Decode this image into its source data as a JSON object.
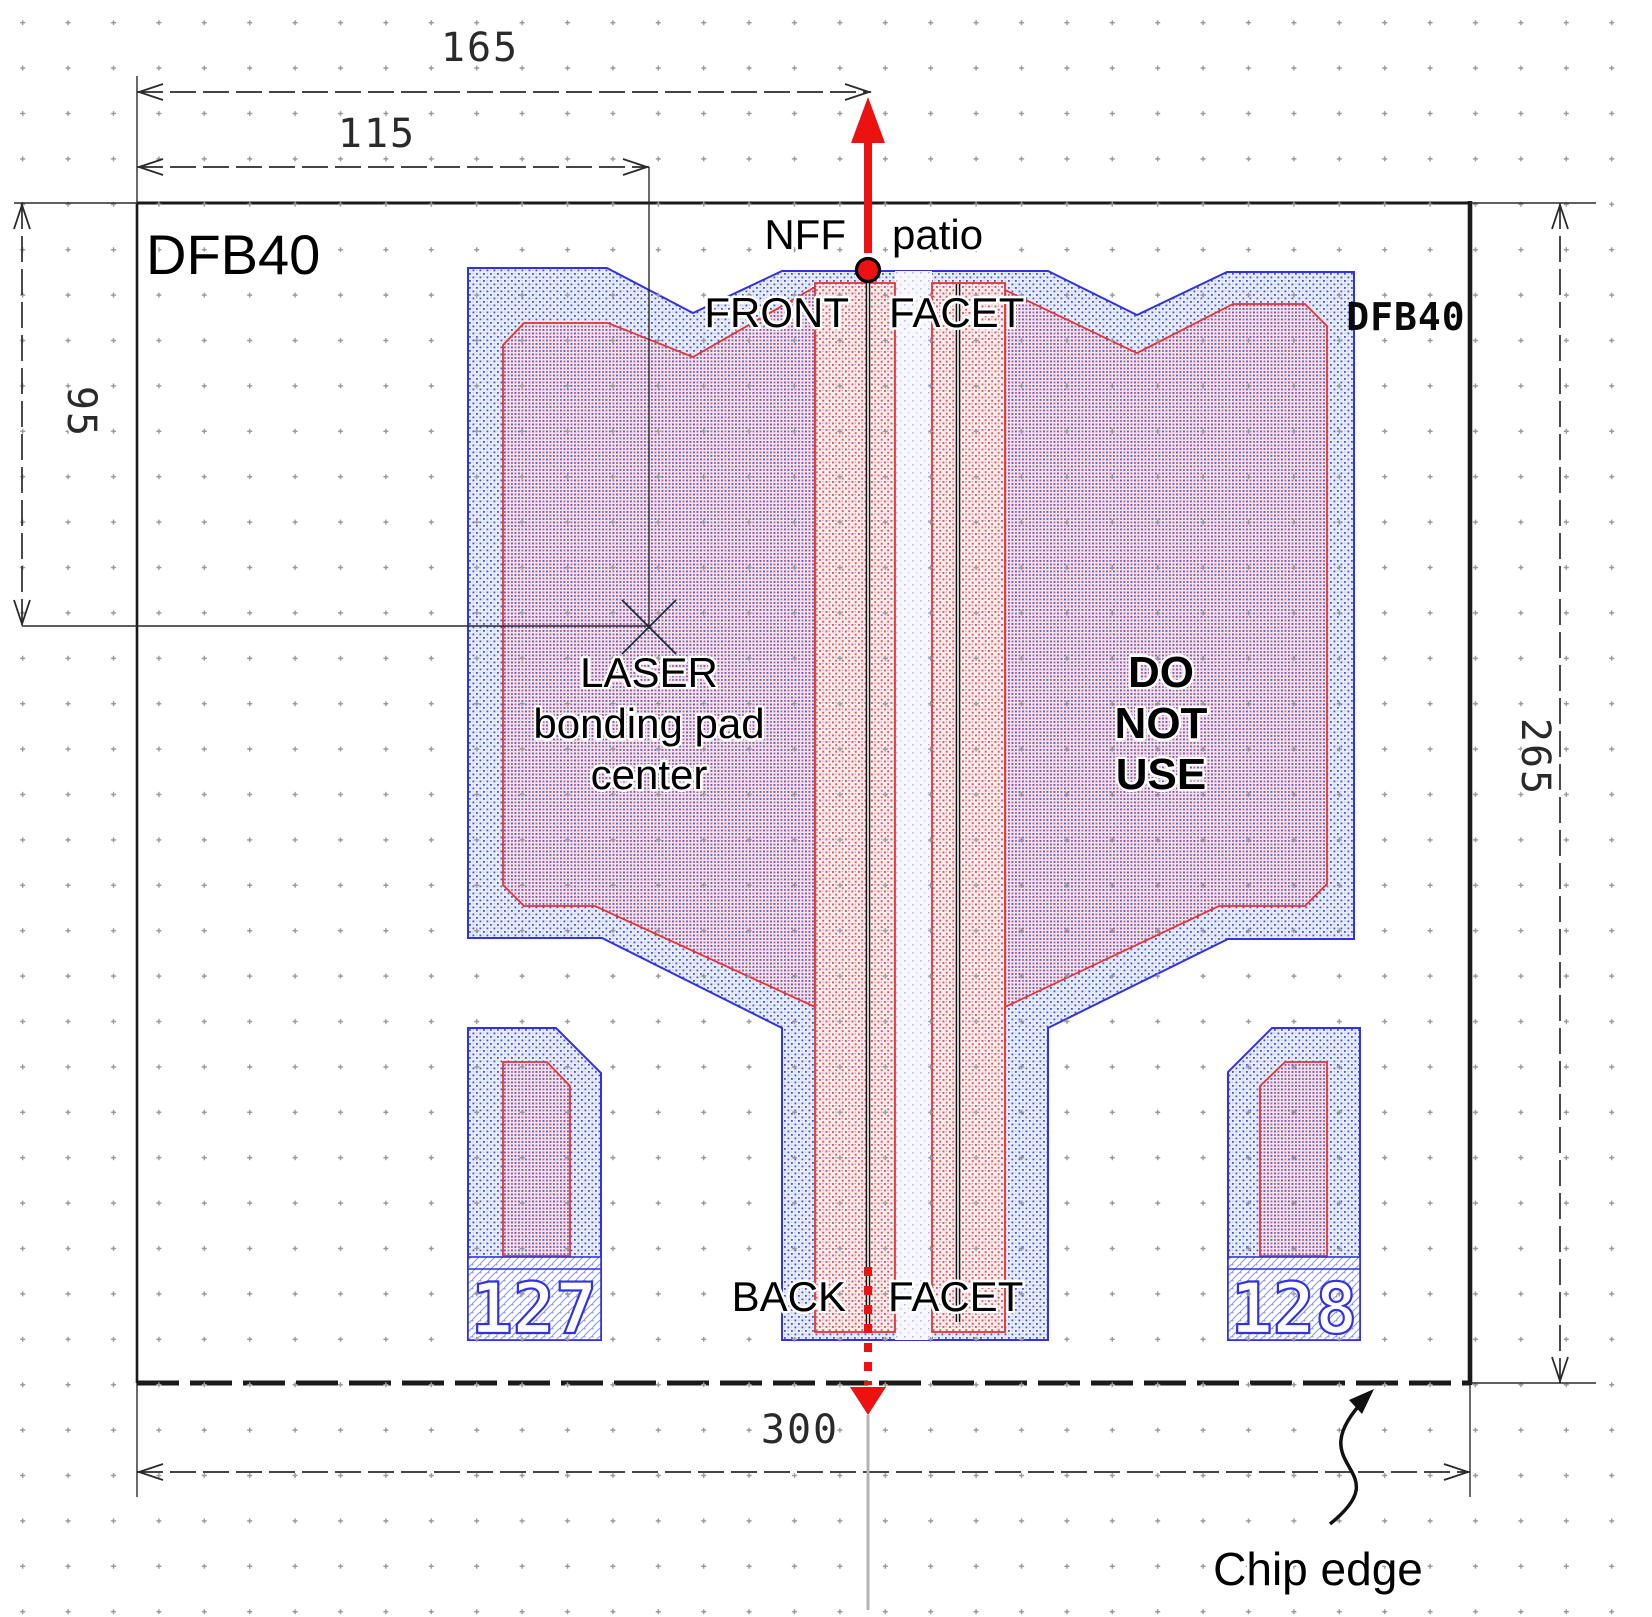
{
  "diagram": {
    "name_top_left": "DFB40",
    "name_top_right": "DFB40",
    "nff_label": "NFF",
    "patio_label": "patio",
    "front_label": "FRONT",
    "front_facet_label": "FACET",
    "back_label": "BACK",
    "back_facet_label": "FACET",
    "laser_line1": "LASER",
    "laser_line2": "bonding pad",
    "laser_line3": "center",
    "dnu_line1": "DO",
    "dnu_line2": "NOT",
    "dnu_line3": "USE",
    "chip_edge_label": "Chip edge",
    "pad_number_left": "127",
    "pad_number_right": "128"
  },
  "dimensions": {
    "top_outer": "165",
    "top_inner": "115",
    "left_height": "95",
    "right_height": "265",
    "bottom_width": "300"
  },
  "colors": {
    "pad_outline_blue": "#3232e0",
    "inner_outline_red": "#e63434",
    "arrow_red": "#ee1111",
    "chip_border": "#1a1a1a",
    "dimension_lines": "#2a2a2a",
    "grid_dots": "#9a9a9a",
    "center_line_gray": "#b3b3b3"
  }
}
